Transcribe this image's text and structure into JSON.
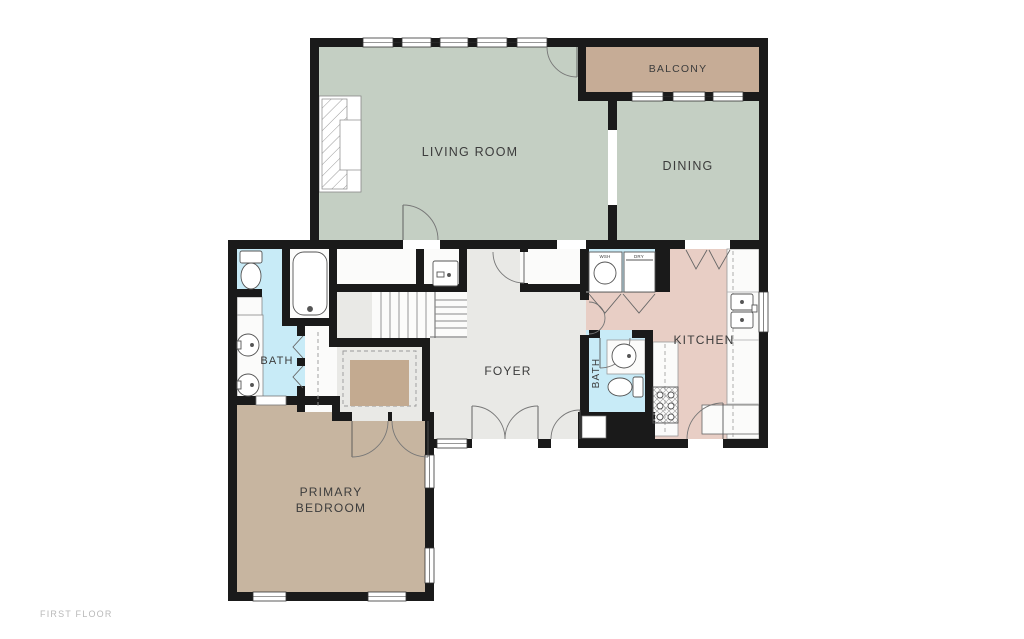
{
  "plan": {
    "floor_label": "FIRST FLOOR"
  },
  "rooms": {
    "living": {
      "label": "LIVING ROOM"
    },
    "dining": {
      "label": "DINING"
    },
    "balcony": {
      "label": "BALCONY"
    },
    "kitchen": {
      "label": "KITCHEN"
    },
    "foyer": {
      "label": "FOYER"
    },
    "primary_bath": {
      "label": "BATH"
    },
    "powder_bath": {
      "label": "BATH"
    },
    "primary_bedroom": {
      "label_line1": "PRIMARY",
      "label_line2": "BEDROOM"
    },
    "laundry": {
      "washer_label": "WSH",
      "dryer_label": "DRY"
    }
  },
  "colors": {
    "wall": "#1a1a1a",
    "living": "#c4cfc3",
    "dining": "#c4cfc3",
    "balcony": "#c6ac96",
    "bedroom": "#c7b5a0",
    "rug": "#c3aa90",
    "kitchen": "#e8cec5",
    "bath": "#c8ebf7",
    "hall": "#e9e9e6",
    "closet_floor": "#f7f7f5",
    "label": "#3c3c3c",
    "floor_label": "#b9b9b9"
  }
}
